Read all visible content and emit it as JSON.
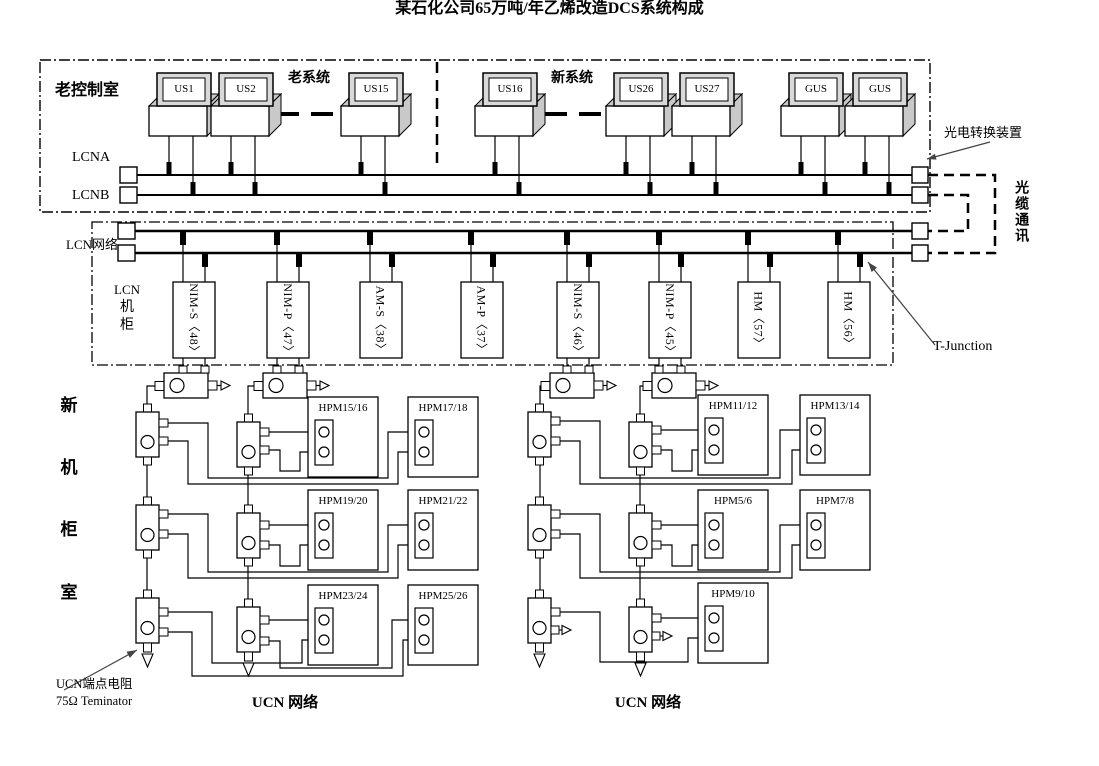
{
  "title": "某石化公司65万吨/年乙烯改造DCS系统构成",
  "old_control_room": {
    "label": "老控制室",
    "old_system_label": "老系统",
    "new_system_label": "新系统",
    "workstations": [
      "US1",
      "US2",
      "US15",
      "US16",
      "US26",
      "US27",
      "GUS",
      "GUS"
    ],
    "lcna_label": "LCNA",
    "lcnb_label": "LCNB"
  },
  "optical": {
    "converter_label": "光电转换装置",
    "fiber_comm_label": "光缆通讯"
  },
  "lcn": {
    "network_label": "LCN网络",
    "cabinet_lines": [
      "LCN",
      "机",
      "柜"
    ],
    "modules": [
      "NIM-S〈48〉",
      "NIM-P〈47〉",
      "AM-S〈38〉",
      "AM-P〈37〉",
      "NIM-S〈46〉",
      "NIM-P〈45〉",
      "HM〈57〉",
      "HM〈56〉"
    ],
    "t_junction_label": "T-Junction"
  },
  "ucn": {
    "room_chars": [
      "新",
      "机",
      "柜",
      "室"
    ],
    "left_hpms": [
      "HPM15/16",
      "HPM17/18",
      "HPM19/20",
      "HPM21/22",
      "HPM23/24",
      "HPM25/26"
    ],
    "right_hpms": [
      "HPM11/12",
      "HPM13/14",
      "HPM5/6",
      "HPM7/8",
      "HPM9/10"
    ],
    "terminator_line1": "UCN端点电阻",
    "terminator_line2": "75Ω Teminator",
    "left_network_label": "UCN 网络",
    "right_network_label": "UCN 网络"
  }
}
